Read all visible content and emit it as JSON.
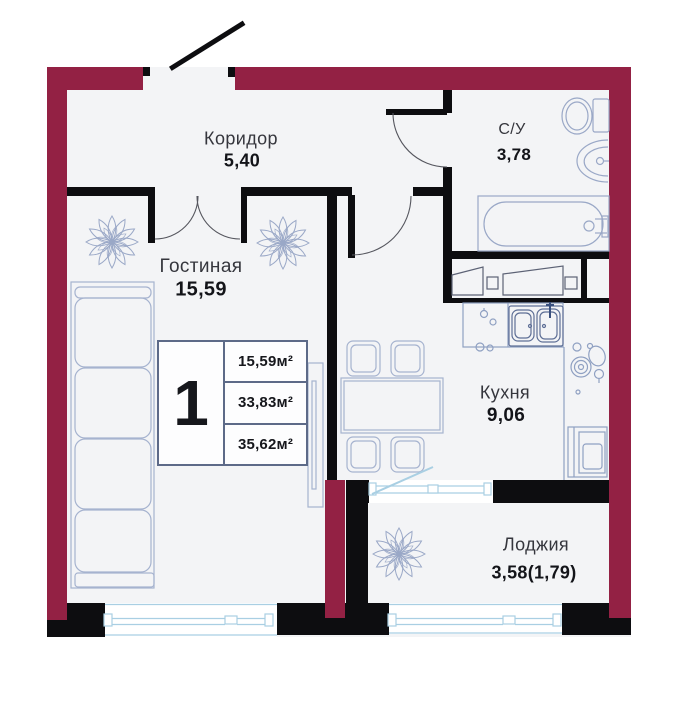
{
  "rooms": {
    "corridor": {
      "name": "Коридор",
      "area": "5,40"
    },
    "bathroom": {
      "name": "С/У",
      "area": "3,78"
    },
    "living": {
      "name": "Гостиная",
      "area": "15,59"
    },
    "kitchen": {
      "name": "Кухня",
      "area": "9,06"
    },
    "loggia": {
      "name": "Лоджия",
      "area": "3,58(1,79)"
    }
  },
  "info_box": {
    "rooms_count": "1",
    "area_living": "15,59м²",
    "area_total": "33,83м²",
    "area_overall": "35,62м²"
  },
  "colors": {
    "exterior_wall": "#932144",
    "interior_wall": "#0d0d10",
    "furniture_line": "#a6b3cf",
    "window_line": "#a9cfe3",
    "info_box_border": "#5d6a88"
  }
}
